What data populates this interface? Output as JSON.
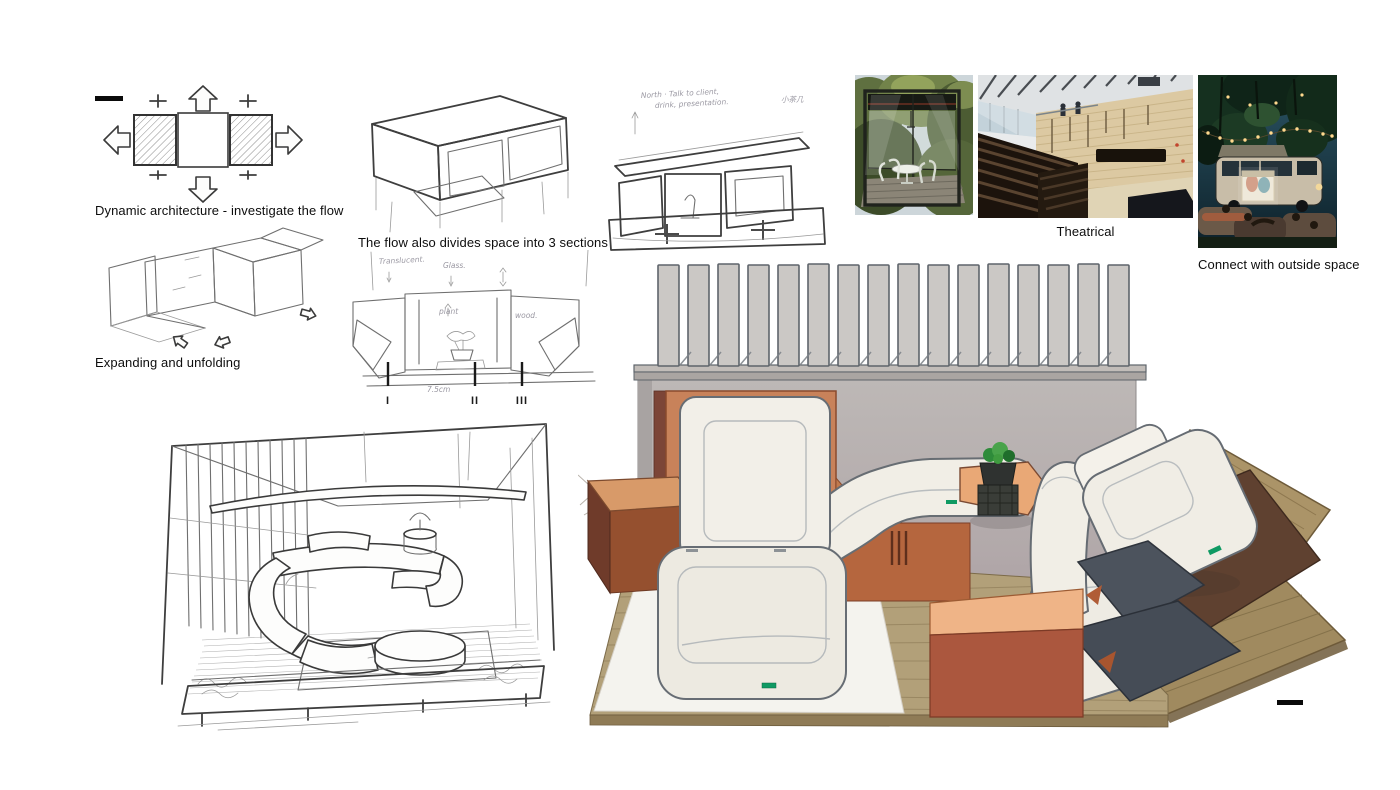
{
  "canvas": {
    "width": 1400,
    "height": 790,
    "background": "#ffffff"
  },
  "captions": {
    "flow": "Dynamic architecture - investigate the flow",
    "expanding": "Expanding and unfolding",
    "sections": "The flow also divides space into 3 sections",
    "theatrical": "Theatrical",
    "outside": "Connect with outside space"
  },
  "handwritten": {
    "concept_note_line1": "North · Talk to client,",
    "concept_note_line2": "drink, presentation.",
    "concept_note_cn": "小茶几",
    "label_translucent": "Translucent.",
    "label_glass": "Glass.",
    "label_plant": "plant",
    "label_wood": "wood.",
    "dim": "7.5cm",
    "numeral_1": "I",
    "numeral_2": "II",
    "numeral_3": "III"
  },
  "photos": {
    "glass_room": {
      "name": "glass-pavilion-photo"
    },
    "auditorium": {
      "name": "theater-auditorium-photo"
    },
    "outdoor_cinema": {
      "name": "outdoor-van-cinema-photo"
    }
  },
  "colors": {
    "panel_orange": "#c8825a",
    "table_orange": "#d89a69",
    "box_top_orange": "#efb487",
    "box_front_red": "#ab573e",
    "wall_gray_top": "#bdb8b6",
    "wall_gray_bottom": "#a5949d",
    "slat_gray": "#cbc8c5",
    "wood_floor": "#b2a079",
    "slate_gray": "#4c535d",
    "seat_white": "#f0ede5",
    "tag_green": "#0f9a63",
    "plant_green": "#3f9b3f"
  }
}
